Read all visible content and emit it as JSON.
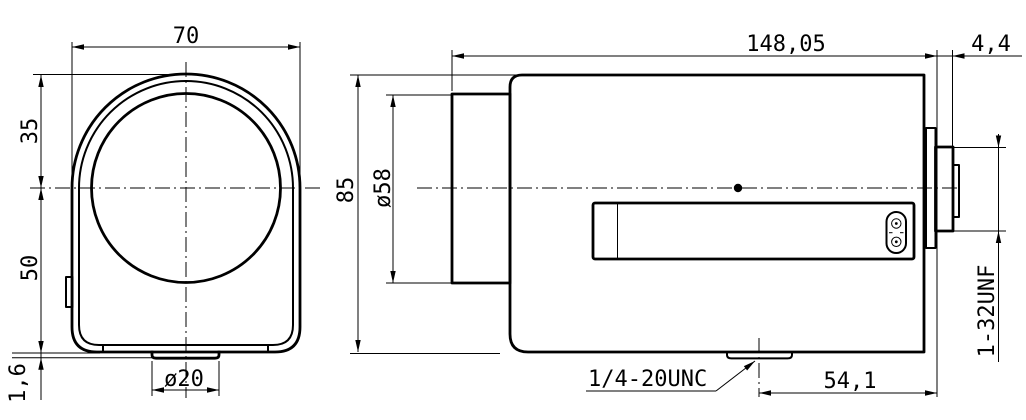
{
  "drawing": {
    "background_color": "#ffffff",
    "line_color": "#000000",
    "front_view": {
      "width_dim": "70",
      "top_to_center_dim": "35",
      "center_to_bottom_dim": "50",
      "boss_height_dim": "1,6",
      "boss_diameter_dim": "ø20"
    },
    "side_view": {
      "body_length_dim": "148,05",
      "mount_protrusion_dim": "4,4",
      "body_height_dim": "85",
      "front_barrel_diameter_dim": "ø58",
      "tripod_thread_label": "1/4-20UNC",
      "tripod_to_rear_dim": "54,1",
      "rear_mount_thread_label": "1-32UNF"
    }
  }
}
